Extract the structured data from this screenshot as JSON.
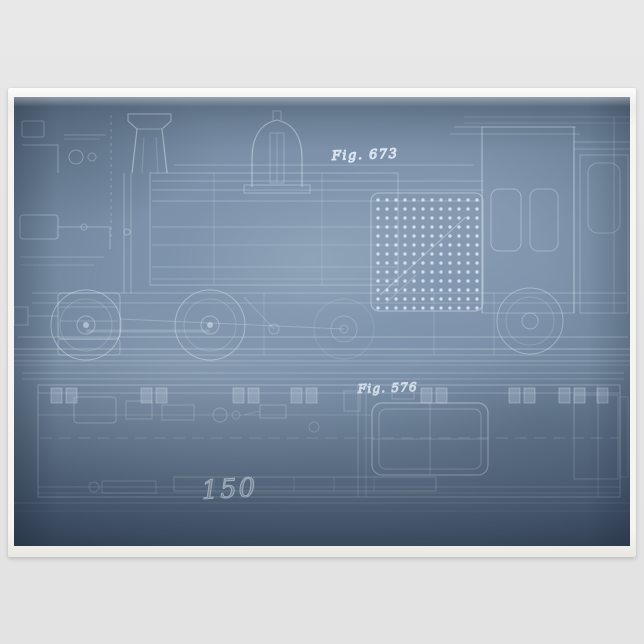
{
  "product_photo": {
    "background_color": "#e5e5e6",
    "paper_color": "#f5f4f1"
  },
  "blueprint": {
    "figure_upper_label": "Fig. 673",
    "figure_lower_label": "Fig. 576",
    "plan_number": "150",
    "colors": {
      "print_blue_center": "#8399b1",
      "print_blue_edge": "#55677d",
      "line_work": "#dce7f2"
    },
    "diagrams": [
      {
        "name": "locomotive-side-elevation",
        "label": "Fig. 673"
      },
      {
        "name": "locomotive-plan-view",
        "label": "Fig. 576"
      }
    ]
  }
}
